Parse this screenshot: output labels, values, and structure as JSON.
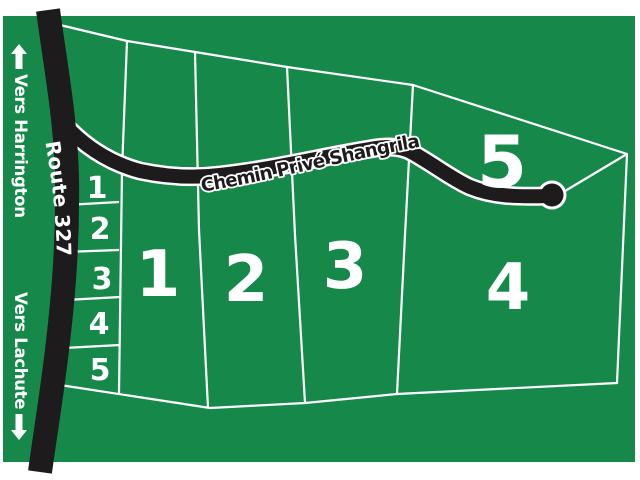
{
  "map": {
    "colors": {
      "background": "#16894A",
      "road": "#1E1B1C",
      "line": "#FFFFFF",
      "text": "#FFFFFF"
    },
    "roads": {
      "route327": {
        "label": "Route 327"
      },
      "chemin_prive": {
        "label": "Chemin Privé Shangrila"
      }
    },
    "directions": {
      "north": {
        "label": "Vers Harrington",
        "arrow": "up-arrow"
      },
      "south": {
        "label": "Vers Lachute",
        "arrow": "down-arrow"
      }
    },
    "large_lots": [
      {
        "number": "1"
      },
      {
        "number": "2"
      },
      {
        "number": "3"
      },
      {
        "number": "4"
      },
      {
        "number": "5"
      }
    ],
    "small_lots": [
      {
        "number": "1"
      },
      {
        "number": "2"
      },
      {
        "number": "3"
      },
      {
        "number": "4"
      },
      {
        "number": "5"
      }
    ]
  }
}
